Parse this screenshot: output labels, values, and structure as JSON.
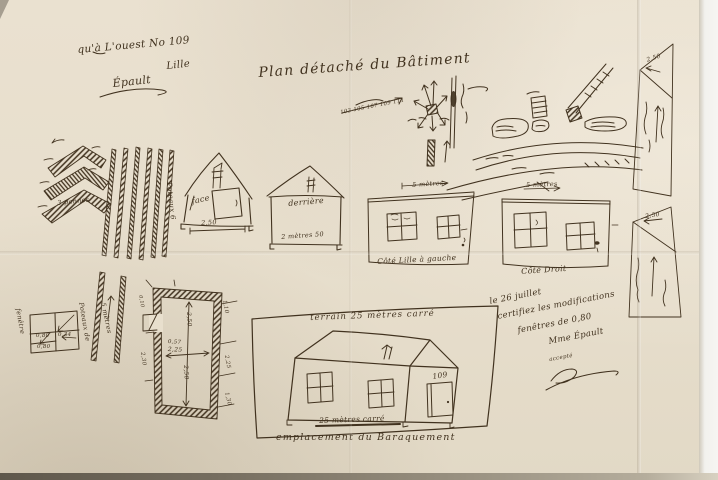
{
  "paper": {
    "background_color": "#e8dfcd",
    "ink_color": "#41321f"
  },
  "header": {
    "corner_note_line1": "qu'à L'ouest No 109",
    "corner_note_line2": "Lille",
    "corner_note_signature": "Épault",
    "title": "Plan détaché du Bâtiment",
    "street_numbers": "103 105 107 109 111"
  },
  "roof_detail": {
    "caption": "3 pannes"
  },
  "planks_top": {
    "caption": "Poteaux 6"
  },
  "house_front": {
    "label": "face",
    "base_dimension": "2,50"
  },
  "house_back": {
    "label": "derrière",
    "base_note": "2 mètres 50"
  },
  "elevation_left": {
    "width_label": "5 mètres",
    "caption": "Côté Lille à gauche"
  },
  "elevation_right": {
    "width_label": "5 mètres",
    "caption": "Côté Droit"
  },
  "gable_top": {
    "dimension": "2,50"
  },
  "gable_bottom": {
    "dimension": "2,50"
  },
  "window_detail": {
    "caption": "fenêtre",
    "dim1": "0,80",
    "dim2": "0,34",
    "dim3": "0,80"
  },
  "planks_bottom": {
    "caption": "Poteaux de",
    "length": "5 mètres"
  },
  "floor_plan": {
    "height_upper": "2,50",
    "height_lower": "2,50",
    "width_note": "0,57",
    "width": "2,25",
    "right_dim1": "1,10",
    "right_dim2": "2,25",
    "right_dim3": "1,30",
    "left_dim": "2,30",
    "door_dim": "0,10"
  },
  "terrain": {
    "area_label": "terrain 25 mètres carré",
    "door_number": "109",
    "base_label": "25 mètres carré",
    "caption": "emplacement du Baraquement"
  },
  "certification": {
    "line1": "le 26 juillet",
    "line2": "certifiez les modifications",
    "line3": "fenêtres de 0,80",
    "line4": "Mme Épault",
    "acceptance": "accepté"
  }
}
